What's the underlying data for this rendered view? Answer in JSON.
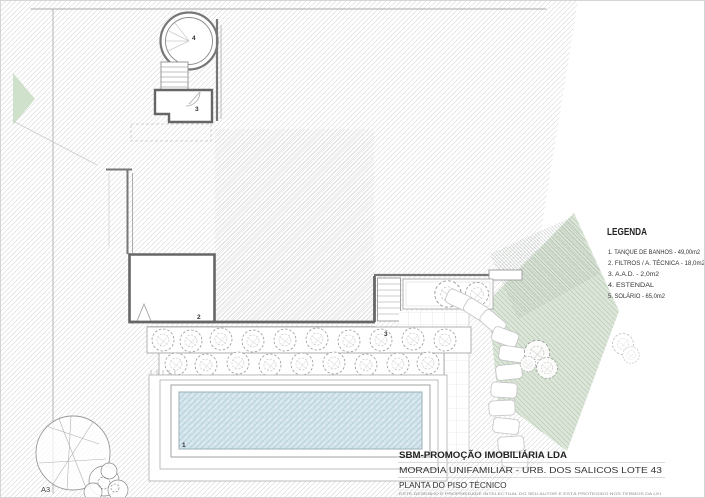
{
  "sheet": {
    "size_label": "A3"
  },
  "legend": {
    "title": "LEGENDA",
    "items": [
      "1. TANQUE DE BANHOS - 49,00m2",
      "2. FILTROS / A. TÉCNICA - 18,0m2",
      "3. A.A.D. - 2,0m2",
      "4. ESTENDAL",
      "5. SOLÁRIO - 65,0m2"
    ]
  },
  "title_block": {
    "company": "SBM-PROMOÇÃO IMOBILIÁRIA LDA",
    "project": "MORADIA UNIFAMILIAR - URB. DOS SALICOS LOTE 43",
    "drawing": "PLANTA DO PISO TÉCNICO",
    "disclaimer": "ESTE DESENHO É PROPRIEDADE INTELECTUAL DO SEU AUTOR E ESTÁ PROTEGIDO NOS TERMOS DA LEI"
  },
  "labels": [
    "4",
    "3",
    "2",
    "3",
    "1"
  ],
  "colors": {
    "hatch_line": "#dedede",
    "wall": "#666666",
    "green_area": "#dbe6d8",
    "green_hatch": "#b9c9b7",
    "pool_water": "#d3e4eb",
    "pool_hatch": "#b8d3de"
  }
}
